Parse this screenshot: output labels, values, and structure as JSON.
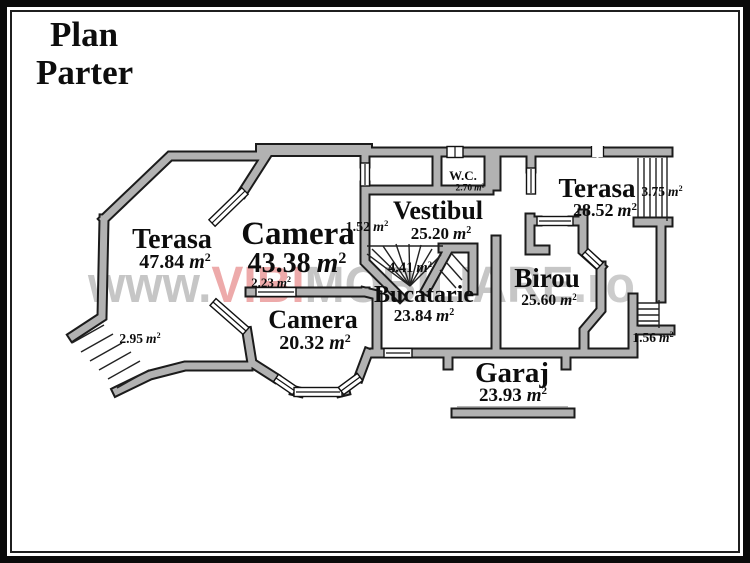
{
  "title": {
    "line1": "Plan",
    "line2": "Parter"
  },
  "watermark": {
    "www": "www.",
    "vibi": "VIBI",
    "mobiliare": "MOBILIARE",
    "ro": ".ro"
  },
  "units": {
    "m": "m",
    "sup": "2"
  },
  "rooms": {
    "terasa_stanga": {
      "name": "Terasa",
      "area": "47.84"
    },
    "camera_mare": {
      "name": "Camera",
      "area": "43.38"
    },
    "camera_mica": {
      "name": "Camera",
      "area": "20.32"
    },
    "vestibul": {
      "name": "Vestibul",
      "area": "25.20"
    },
    "wc": {
      "name": "W.C.",
      "area": "2.70"
    },
    "bucatarie": {
      "name": "Bucatarie",
      "area": "23.84"
    },
    "birou": {
      "name": "Birou",
      "area": "25.60"
    },
    "terasa_dreapta": {
      "name": "Terasa",
      "area": "28.52"
    },
    "garaj": {
      "name": "Garaj",
      "area": "23.93"
    }
  },
  "small_areas": {
    "s1": "1.52",
    "s2": "2.23",
    "s3": "2.95",
    "s4": "4.41",
    "s5": "3.75",
    "s6": "1.56"
  },
  "colors": {
    "wall_fill": "#b2b2b2",
    "wall_outline": "#1b1b1b",
    "watermark_gray": "#c6c6c6",
    "watermark_red": "#edaaaa",
    "background": "#ffffff",
    "text": "#0d0d0d"
  }
}
